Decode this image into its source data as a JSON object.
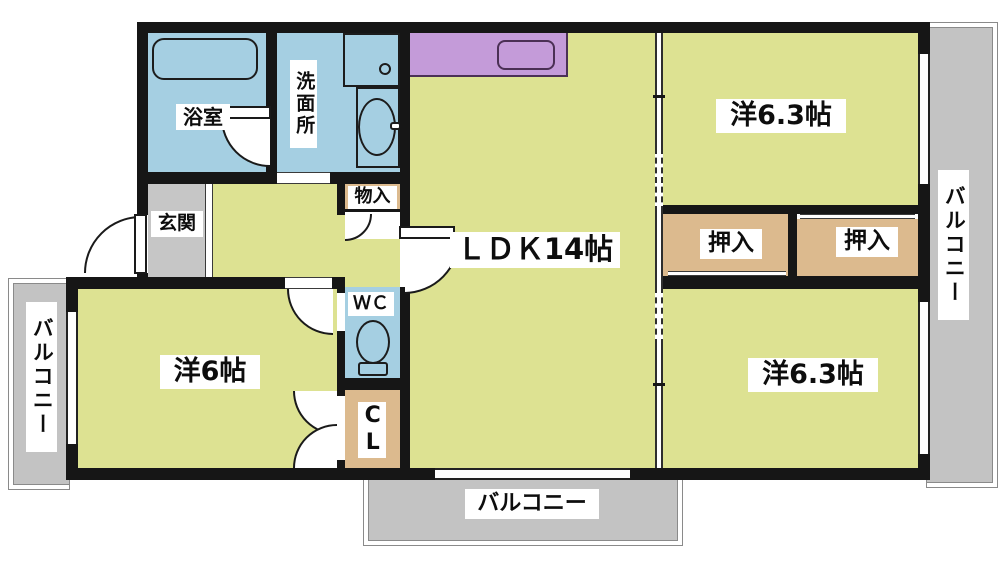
{
  "type": "apartment-floor-plan",
  "labels": {
    "bath": "浴室",
    "washroom": "洗面所",
    "entrance": "玄関",
    "storage": "物入",
    "ldk": "ＬＤＫ14帖",
    "western_top": "洋6.3帖",
    "western_bottom": "洋6.3帖",
    "western_left": "洋6帖",
    "closet_top": "押入",
    "closet_bottom": "押入",
    "wc": "ＷＣ",
    "cl": "CL",
    "balcony_left": "バルコニー",
    "balcony_right": "バルコニー",
    "balcony_bottom": "バルコニー"
  },
  "colors": {
    "room_yellow": "#dde292",
    "wet_area_cyan": "#a5cfe2",
    "closet_tan": "#dcba8e",
    "kitchen_purple": "#c49bd9",
    "entrance_gray": "#c6c6c6",
    "balcony_gray": "#c3c3c3",
    "wall_black": "#161616",
    "label_background": "#ffffff"
  }
}
